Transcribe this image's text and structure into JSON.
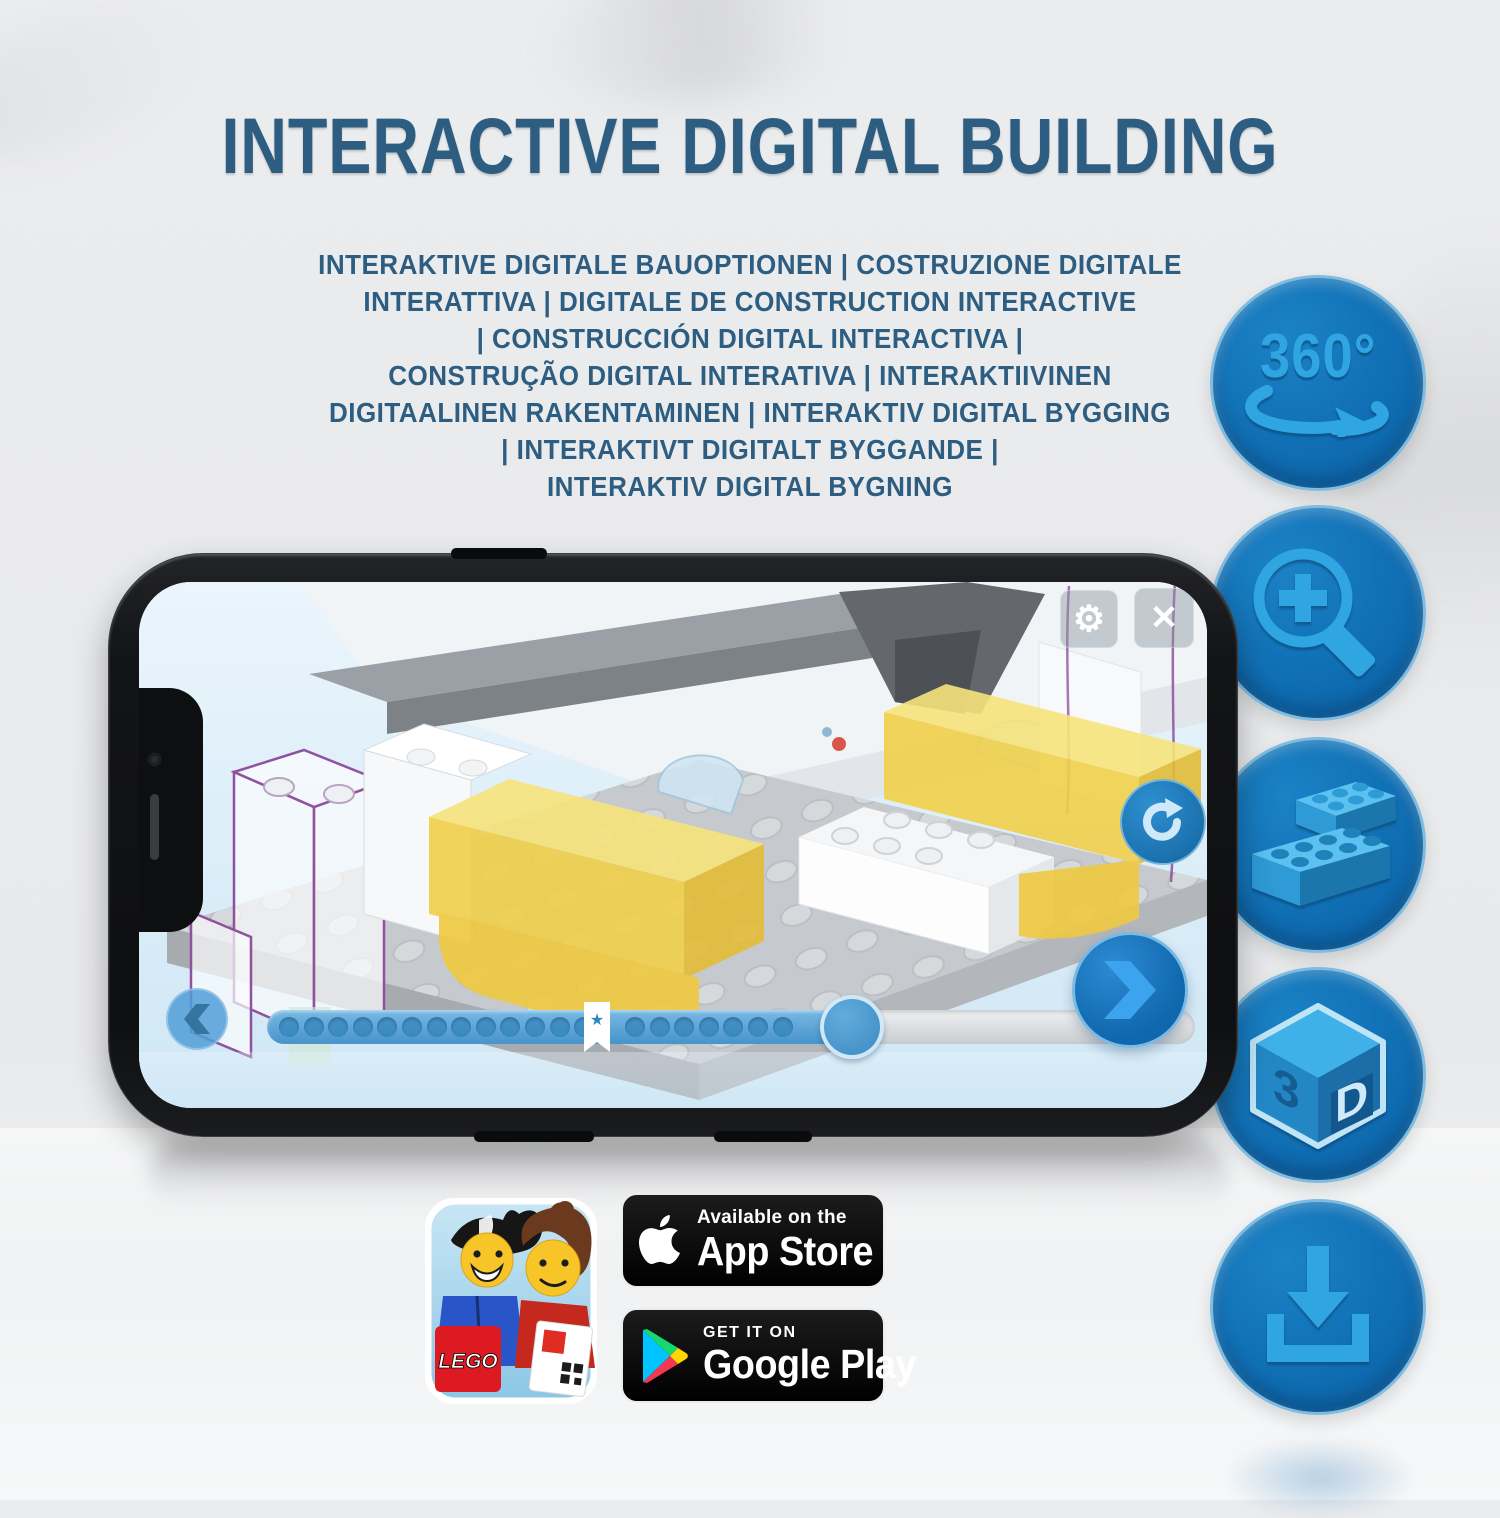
{
  "title": "INTERACTIVE DIGITAL BUILDING",
  "subtitle_lines": [
    "INTERAKTIVE DIGITALE BAUOPTIONEN | COSTRUZIONE DIGITALE",
    "INTERATTIVA | DIGITALE DE CONSTRUCTION INTERACTIVE",
    "| CONSTRUCCIÓN DIGITAL INTERACTIVA |",
    "CONSTRUÇÃO DIGITAL INTERATIVA | INTERAKTIIVINEN",
    "DIGITAALINEN RAKENTAMINEN | INTERAKTIV DIGITAL BYGGING",
    "| INTERAKTIVT DIGITALT BYGGANDE |",
    "INTERAKTIV DIGITAL BYGNING"
  ],
  "features": [
    {
      "icon": "rotate-360-icon",
      "label": "360°"
    },
    {
      "icon": "zoom-in-icon"
    },
    {
      "icon": "lego-brick-icon"
    },
    {
      "icon": "cube-3d-icon",
      "label_left": "3",
      "label_right": "D"
    },
    {
      "icon": "download-icon"
    }
  ],
  "phone": {
    "screen_icons": {
      "settings": "⚙",
      "close": "✕",
      "bookmark_star": "★"
    },
    "progress": {
      "dots_before_bookmark": 13,
      "dots_after_bookmark": 7,
      "percent_complete": 63
    }
  },
  "store": {
    "lego_app_logo_text": "LEGO",
    "app_store": {
      "line1": "Available on the",
      "line2": "App Store"
    },
    "google_play": {
      "line1": "GET IT ON",
      "line2": "Google Play"
    }
  },
  "colors": {
    "headline": "#2d5e81",
    "icon_circle": "#0f6cb1",
    "icon_glyph": "#2fa6e2",
    "screen_bg": "#dbeef9",
    "progress_fill": "#4693cb",
    "lego_yellow": "#f1d04b"
  }
}
